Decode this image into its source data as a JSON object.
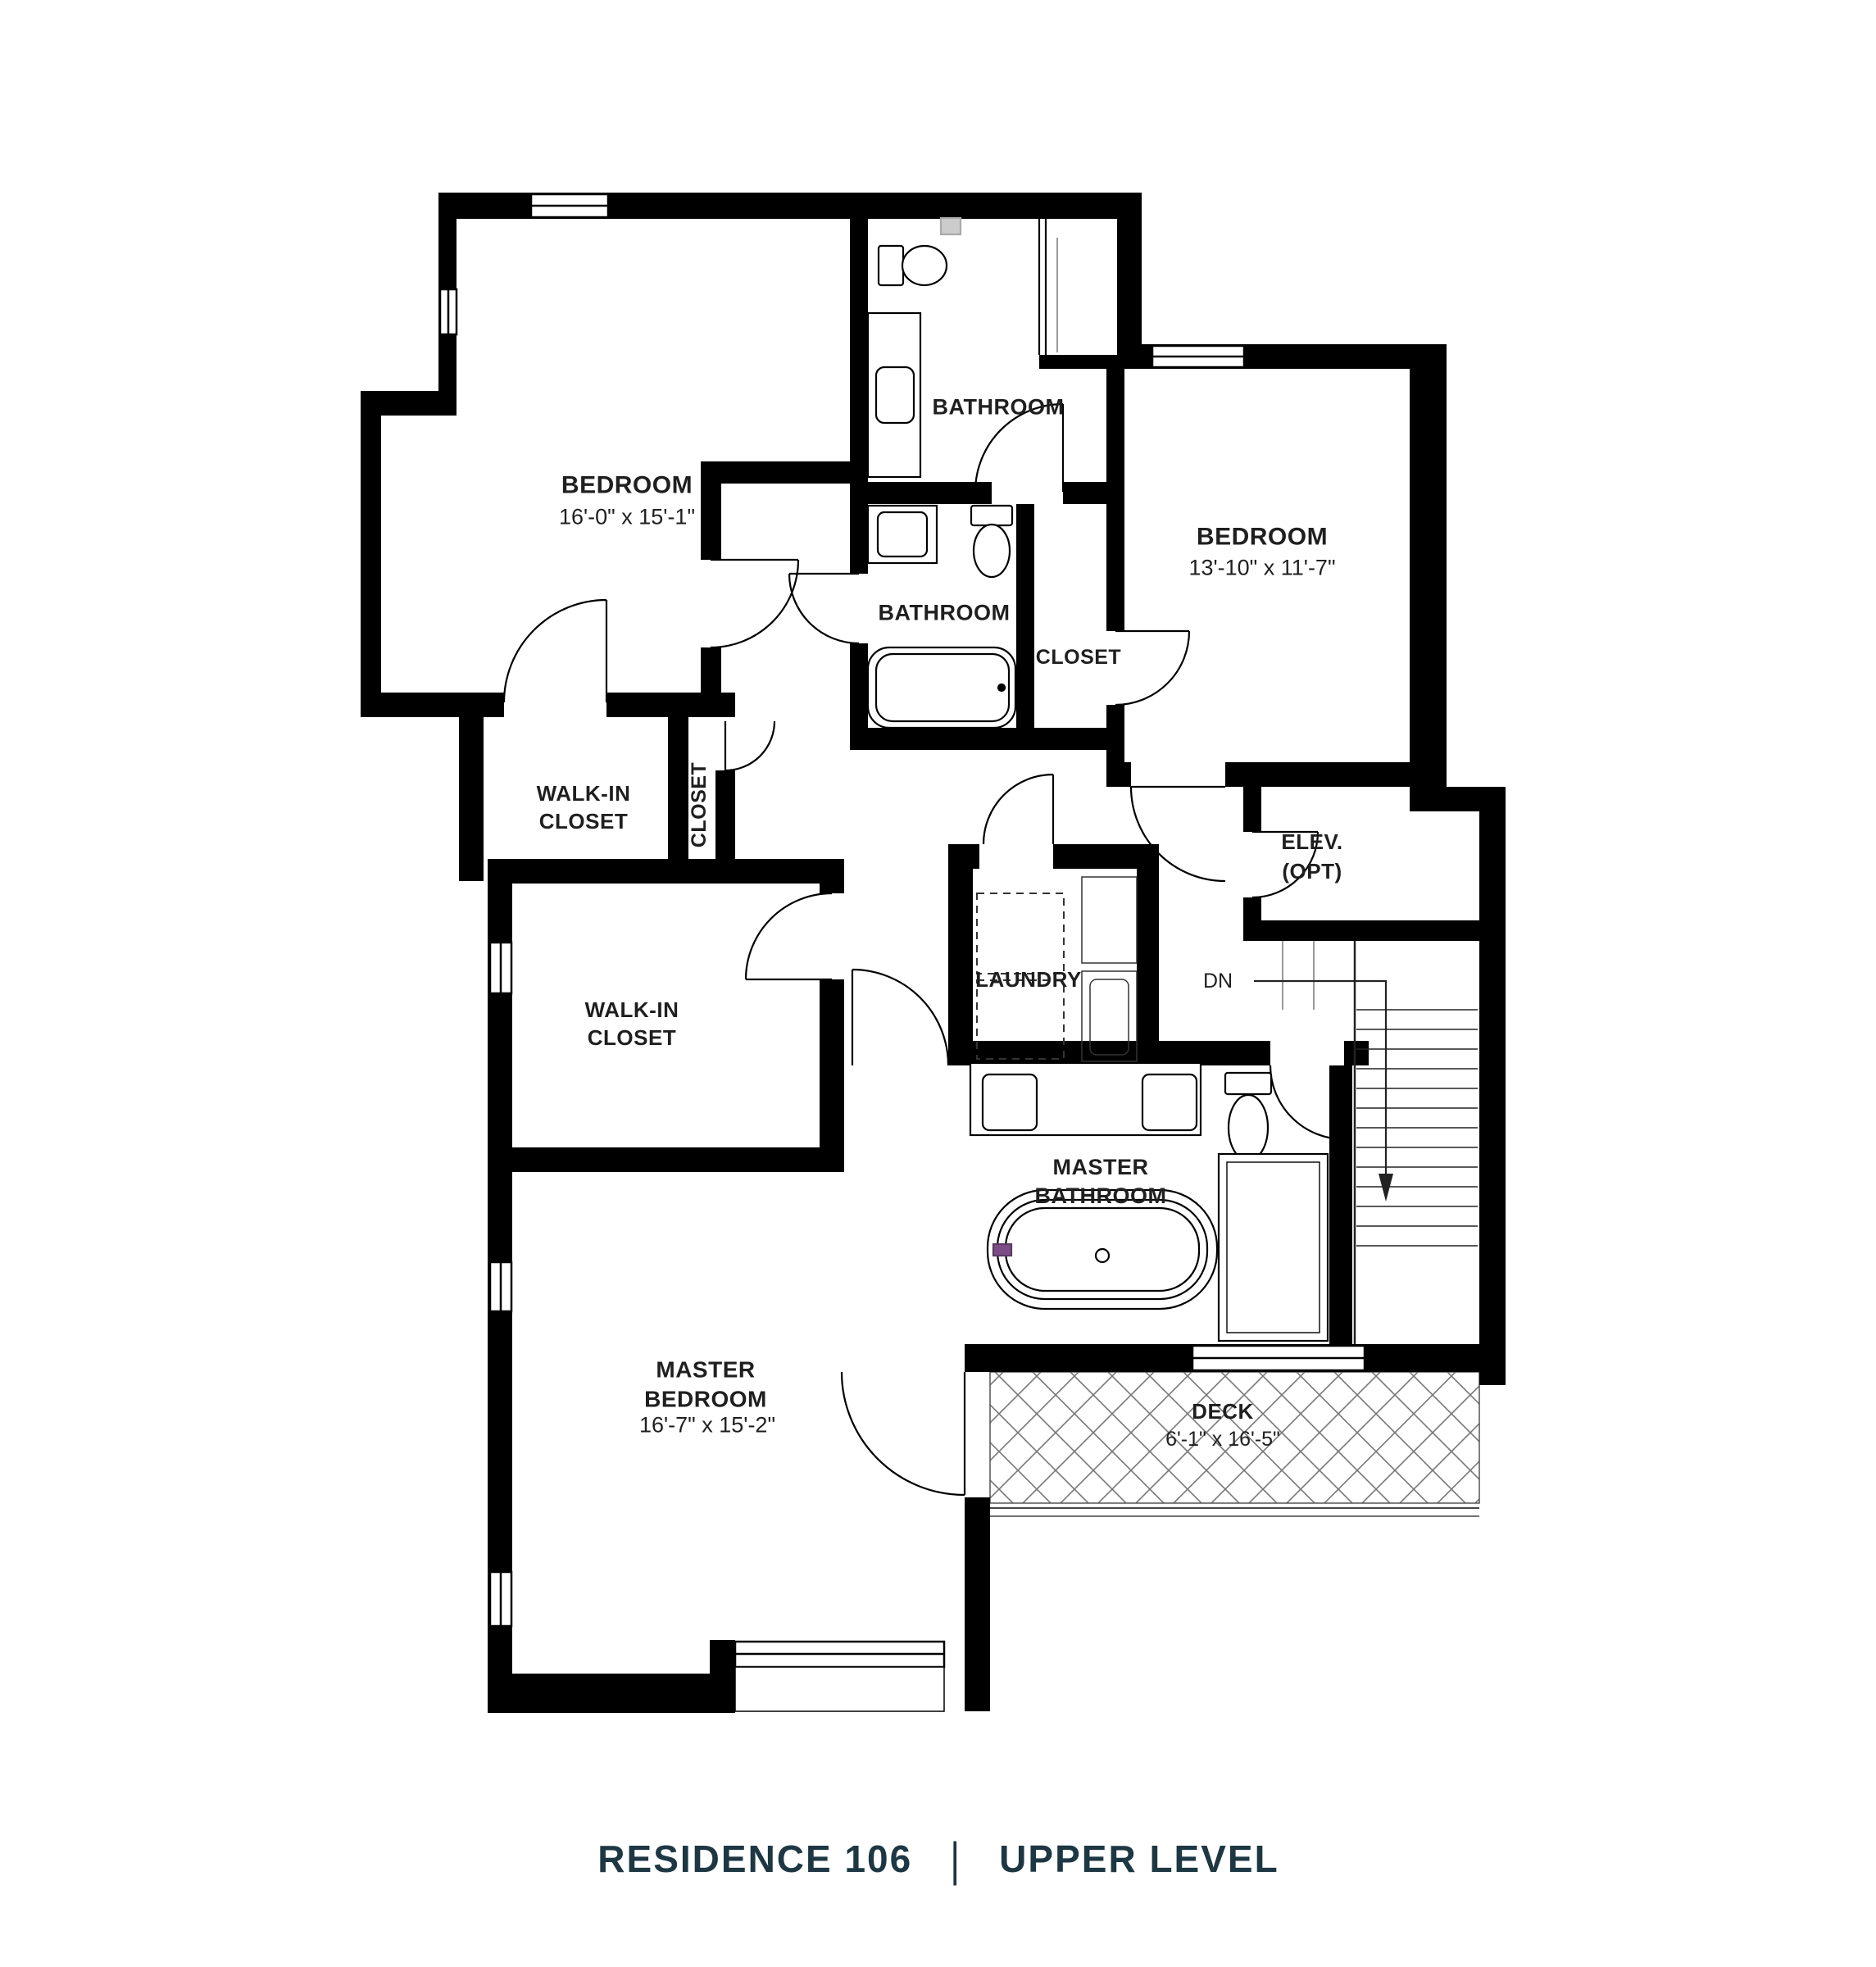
{
  "title": {
    "left": "RESIDENCE 106",
    "separator": "|",
    "right": "UPPER LEVEL"
  },
  "colors": {
    "wall": "#000000",
    "title_text": "#1d3743",
    "label_text": "#1f1f1f"
  },
  "rooms": {
    "bedroom_top_left": {
      "name": "BEDROOM",
      "dims": "16'-0\" x 15'-1\""
    },
    "bedroom_right": {
      "name": "BEDROOM",
      "dims": "13'-10\" x 11'-7\""
    },
    "bathroom_top": {
      "name": "BATHROOM"
    },
    "bathroom_middle": {
      "name": "BATHROOM"
    },
    "closet_hall": {
      "name": "CLOSET"
    },
    "closet_bedroom_right": {
      "name": "CLOSET"
    },
    "walk_in_closet_upper": {
      "name": "WALK-IN CLOSET"
    },
    "walk_in_closet_lower": {
      "name": "WALK-IN CLOSET"
    },
    "elevator": {
      "name": "ELEV.",
      "option": "(OPT)"
    },
    "laundry": {
      "name": "LAUNDRY"
    },
    "stairs": {
      "label": "DN"
    },
    "master_bathroom": {
      "name": "MASTER BATHROOM"
    },
    "master_bedroom": {
      "name": "MASTER BEDROOM",
      "dims": "16'-7\" x 15'-2\""
    },
    "deck": {
      "name": "DECK",
      "dims": "6'-1\" x 16'-5\""
    }
  }
}
